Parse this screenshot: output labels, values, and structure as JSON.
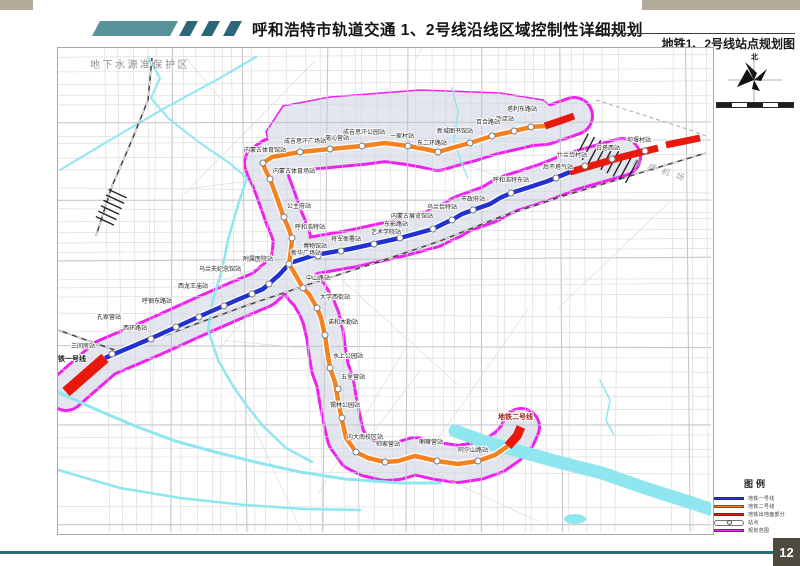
{
  "page": {
    "number": "12"
  },
  "header": {
    "title": "呼和浩特市轨道交通 1、2号线沿线区域控制性详细规划",
    "subtitle": "地铁1、2号线站点规划图"
  },
  "compass": {
    "north_label": "北"
  },
  "legend": {
    "title": "图例",
    "items": [
      {
        "type": "line",
        "color": "#2331d0",
        "label": "地铁一号线"
      },
      {
        "type": "line",
        "color": "#f5821f",
        "label": "地铁二号线"
      },
      {
        "type": "line",
        "color": "#e8180c",
        "label": "地铁出地面部分"
      },
      {
        "type": "station",
        "color": "#ffffff",
        "label": "站点"
      },
      {
        "type": "line",
        "color": "#ee22ee",
        "label": "规划范围"
      }
    ]
  },
  "map": {
    "labels": {
      "protection_zone": "地下水源准保护区",
      "airport": "白塔机场",
      "line1_terminal": "地铁一号线",
      "line2_terminal": "地铁二号线"
    },
    "colors": {
      "line1": "#2331d0",
      "line2": "#f5821f",
      "surface": "#e8180c",
      "boundary": "#ee22ee",
      "corridor": "#e3e6ee",
      "river": "#8fe6ef",
      "road": "#d7d7dd",
      "road_major": "#c6c6cf",
      "rail": "#4a4a4a",
      "label": "#1b1b1b"
    },
    "north_lobe": [
      [
        266,
        132
      ],
      [
        283,
        106
      ],
      [
        330,
        97
      ],
      [
        420,
        90
      ],
      [
        500,
        93
      ],
      [
        543,
        100
      ],
      [
        558,
        112
      ],
      [
        543,
        128
      ],
      [
        480,
        148
      ],
      [
        420,
        151
      ],
      [
        350,
        156
      ],
      [
        300,
        161
      ],
      [
        272,
        152
      ]
    ],
    "line1": {
      "name": "地铁一号线",
      "path": [
        [
          105,
          358
        ],
        [
          152,
          338
        ],
        [
          205,
          314
        ],
        [
          237,
          300
        ],
        [
          263,
          289
        ],
        [
          279,
          275
        ],
        [
          290,
          263
        ],
        [
          315,
          255
        ],
        [
          350,
          249
        ],
        [
          400,
          238
        ],
        [
          433,
          229
        ],
        [
          447,
          222
        ],
        [
          452,
          220
        ],
        [
          462,
          214
        ],
        [
          473,
          210
        ],
        [
          490,
          204
        ],
        [
          500,
          198
        ],
        [
          511,
          193
        ],
        [
          530,
          187
        ],
        [
          548,
          181
        ],
        [
          570,
          172
        ]
      ],
      "surface_segments": [
        {
          "w": 11,
          "pts": [
            [
              66,
              392
            ],
            [
              105,
              358
            ]
          ]
        },
        {
          "w": 7,
          "pts": [
            [
              570,
              172
            ],
            [
              622,
              157
            ],
            [
              658,
              148
            ]
          ]
        },
        {
          "w": 7,
          "pts": [
            [
              666,
              145
            ],
            [
              700,
              138
            ]
          ]
        }
      ],
      "terminal_label_pos": [
        51,
        361
      ],
      "stations": [
        {
          "name": "三间房站",
          "x": 112,
          "y": 354,
          "lx": 71,
          "ly": 348
        },
        {
          "name": "西环路站",
          "x": 151,
          "y": 339,
          "lx": 123,
          "ly": 330
        },
        {
          "name": "孔家营站",
          "x": 176,
          "y": 327,
          "lx": 97,
          "ly": 319
        },
        {
          "name": "呼钢东路站",
          "x": 199,
          "y": 317,
          "lx": 142,
          "ly": 303
        },
        {
          "name": "西龙王庙站",
          "x": 224,
          "y": 306,
          "lx": 178,
          "ly": 288
        },
        {
          "name": "乌兰夫纪念馆站",
          "x": 252,
          "y": 294,
          "lx": 199,
          "ly": 271
        },
        {
          "name": "附属医院站",
          "x": 269,
          "y": 284,
          "lx": 243,
          "ly": 261
        },
        {
          "name": "新华广场站",
          "x": 289,
          "y": 264,
          "lx": 291,
          "ly": 255
        },
        {
          "name": "博物馆站",
          "x": 318,
          "y": 256,
          "lx": 303,
          "ly": 248
        },
        {
          "name": "将军衙署站",
          "x": 341,
          "y": 251,
          "lx": 331,
          "ly": 241
        },
        {
          "name": "艺术学院站",
          "x": 374,
          "y": 244,
          "lx": 371,
          "ly": 234
        },
        {
          "name": "东影路站",
          "x": 400,
          "y": 238,
          "lx": 384,
          "ly": 226
        },
        {
          "name": "内蒙古展览馆站",
          "x": 433,
          "y": 229,
          "lx": 391,
          "ly": 218
        },
        {
          "name": "乌兰恰特站",
          "x": 452,
          "y": 220,
          "lx": 427,
          "ly": 209
        },
        {
          "name": "市政府站",
          "x": 473,
          "y": 210,
          "lx": 461,
          "ly": 201
        },
        {
          "name": "呼和浩特东站",
          "x": 511,
          "y": 193,
          "lx": 493,
          "ly": 182
        },
        {
          "name": "后不塔气站",
          "x": 556,
          "y": 178,
          "lx": 543,
          "ly": 169
        },
        {
          "name": "什兰岱村站",
          "x": 585,
          "y": 166,
          "lx": 557,
          "ly": 157
        },
        {
          "name": "白塔西站",
          "x": 612,
          "y": 159,
          "lx": 596,
          "ly": 150
        },
        {
          "name": "坝堰村站",
          "x": 645,
          "y": 151,
          "lx": 627,
          "ly": 142
        }
      ]
    },
    "line2": {
      "name": "地铁二号线",
      "path": [
        [
          508,
          446
        ],
        [
          495,
          455
        ],
        [
          478,
          461
        ],
        [
          458,
          464
        ],
        [
          437,
          461
        ],
        [
          415,
          456
        ],
        [
          398,
          461
        ],
        [
          385,
          462
        ],
        [
          368,
          458
        ],
        [
          356,
          452
        ],
        [
          346,
          438
        ],
        [
          342,
          420
        ],
        [
          338,
          400
        ],
        [
          335,
          382
        ],
        [
          330,
          368
        ],
        [
          327,
          350
        ],
        [
          325,
          335
        ],
        [
          321,
          318
        ],
        [
          317,
          308
        ],
        [
          309,
          294
        ],
        [
          303,
          288
        ],
        [
          295,
          274
        ],
        [
          289,
          264
        ],
        [
          291,
          250
        ],
        [
          292,
          238
        ],
        [
          288,
          227
        ],
        [
          284,
          218
        ],
        [
          277,
          198
        ],
        [
          270,
          179
        ],
        [
          265,
          169
        ],
        [
          263,
          163
        ],
        [
          272,
          157
        ],
        [
          300,
          152
        ],
        [
          330,
          149
        ],
        [
          362,
          146
        ],
        [
          385,
          143
        ],
        [
          408,
          146
        ],
        [
          425,
          149
        ],
        [
          438,
          152
        ],
        [
          455,
          147
        ],
        [
          470,
          143
        ],
        [
          492,
          136
        ],
        [
          514,
          131
        ],
        [
          531,
          127
        ],
        [
          545,
          126
        ]
      ],
      "surface_segments": [
        {
          "w": 7,
          "pts": [
            [
              545,
              126
            ],
            [
              560,
              121
            ],
            [
              574,
              116
            ]
          ]
        },
        {
          "w": 9,
          "pts": [
            [
              508,
              446
            ],
            [
              517,
              436
            ],
            [
              521,
              427
            ]
          ]
        }
      ],
      "terminal_label_pos": [
        498,
        419
      ],
      "stations": [
        {
          "name": "塔利东路站",
          "x": 531,
          "y": 127,
          "lx": 507,
          "ly": 111
        },
        {
          "name": "新店站",
          "x": 514,
          "y": 131,
          "lx": 496,
          "ly": 121
        },
        {
          "name": "百合路站",
          "x": 492,
          "y": 136,
          "lx": 476,
          "ly": 124
        },
        {
          "name": "新城图书馆站",
          "x": 470,
          "y": 143,
          "lx": 437,
          "ly": 133
        },
        {
          "name": "东二环路站",
          "x": 438,
          "y": 152,
          "lx": 417,
          "ly": 145
        },
        {
          "name": "一家村站",
          "x": 408,
          "y": 146,
          "lx": 390,
          "ly": 138
        },
        {
          "name": "成吉思汗公园站",
          "x": 362,
          "y": 146,
          "lx": 343,
          "ly": 134
        },
        {
          "name": "毫沁营站",
          "x": 330,
          "y": 149,
          "lx": 325,
          "ly": 140
        },
        {
          "name": "成吉思汗广场站",
          "x": 300,
          "y": 152,
          "lx": 284,
          "ly": 143
        },
        {
          "name": "内蒙古体育馆站",
          "x": 263,
          "y": 163,
          "lx": 244,
          "ly": 152
        },
        {
          "name": "内蒙古体育场站",
          "x": 270,
          "y": 179,
          "lx": 273,
          "ly": 173
        },
        {
          "name": "公主府站",
          "x": 284,
          "y": 217,
          "lx": 287,
          "ly": 208
        },
        {
          "name": "呼和浩特站",
          "x": 292,
          "y": 238,
          "lx": 295,
          "ly": 229
        },
        {
          "name": "中山路站",
          "x": 303,
          "y": 288,
          "lx": 306,
          "ly": 280
        },
        {
          "name": "大学西街站",
          "x": 317,
          "y": 308,
          "lx": 320,
          "ly": 299
        },
        {
          "name": "诺和木勒站",
          "x": 325,
          "y": 335,
          "lx": 328,
          "ly": 324
        },
        {
          "name": "水上公园站",
          "x": 330,
          "y": 368,
          "lx": 333,
          "ly": 358
        },
        {
          "name": "五里营站",
          "x": 338,
          "y": 389,
          "lx": 341,
          "ly": 379
        },
        {
          "name": "锡林公园站",
          "x": 342,
          "y": 418,
          "lx": 330,
          "ly": 407
        },
        {
          "name": "内大南校区站",
          "x": 356,
          "y": 452,
          "lx": 347,
          "ly": 439
        },
        {
          "name": "帅家营站",
          "x": 385,
          "y": 462,
          "lx": 376,
          "ly": 446
        },
        {
          "name": "喇嘛营站",
          "x": 437,
          "y": 461,
          "lx": 419,
          "ly": 444
        },
        {
          "name": "阿尔山路站",
          "x": 478,
          "y": 461,
          "lx": 458,
          "ly": 452
        }
      ]
    },
    "rivers": [
      {
        "w": 2,
        "pts": [
          [
            60,
            170
          ],
          [
            110,
            140
          ],
          [
            165,
            108
          ],
          [
            220,
            78
          ],
          [
            256,
            57
          ]
        ]
      },
      {
        "w": 2,
        "pts": [
          [
            148,
            57
          ],
          [
            160,
            78
          ],
          [
            151,
            98
          ],
          [
            168,
            118
          ],
          [
            200,
            143
          ],
          [
            228,
            162
          ],
          [
            247,
            178
          ]
        ]
      },
      {
        "w": 2.5,
        "pts": [
          [
            247,
            178
          ],
          [
            238,
            205
          ],
          [
            228,
            240
          ],
          [
            222,
            270
          ],
          [
            213,
            300
          ],
          [
            208,
            330
          ],
          [
            218,
            360
          ],
          [
            233,
            386
          ],
          [
            247,
            406
          ],
          [
            263,
            426
          ],
          [
            286,
            448
          ],
          [
            312,
            462
          ]
        ]
      },
      {
        "w": 3,
        "pts": [
          [
            58,
            392
          ],
          [
            95,
            409
          ],
          [
            135,
            426
          ],
          [
            175,
            441
          ],
          [
            215,
            452
          ],
          [
            255,
            462
          ],
          [
            300,
            472
          ],
          [
            345,
            479
          ],
          [
            400,
            483
          ],
          [
            440,
            483
          ]
        ]
      },
      {
        "w": 2.5,
        "pts": [
          [
            58,
            470
          ],
          [
            120,
            488
          ],
          [
            180,
            498
          ],
          [
            245,
            505
          ],
          [
            305,
            509
          ],
          [
            360,
            510
          ]
        ]
      },
      {
        "w": 1.5,
        "pts": [
          [
            452,
            88
          ],
          [
            458,
            112
          ],
          [
            454,
            140
          ],
          [
            461,
            162
          ],
          [
            468,
            178
          ]
        ]
      },
      {
        "w": 13,
        "pts": [
          [
            455,
            431
          ],
          [
            492,
            444
          ],
          [
            522,
            452
          ],
          [
            562,
            463
          ],
          [
            602,
            473
          ],
          [
            648,
            489
          ],
          [
            692,
            503
          ],
          [
            710,
            509
          ]
        ]
      },
      {
        "w": 1.5,
        "pts": [
          [
            600,
            380
          ],
          [
            610,
            400
          ],
          [
            606,
            420
          ],
          [
            614,
            435
          ]
        ]
      }
    ],
    "pond": {
      "cx": 575,
      "cy": 519,
      "rx": 11,
      "ry": 5
    },
    "railways": [
      [
        [
          58,
          330
        ],
        [
          120,
          352
        ],
        [
          185,
          328
        ],
        [
          245,
          306
        ],
        [
          310,
          284
        ],
        [
          375,
          263
        ],
        [
          440,
          241
        ],
        [
          500,
          217
        ],
        [
          560,
          197
        ],
        [
          620,
          179
        ],
        [
          706,
          153
        ]
      ],
      [
        [
          96,
          236
        ],
        [
          112,
          186
        ],
        [
          132,
          140
        ],
        [
          148,
          100
        ],
        [
          152,
          58
        ]
      ]
    ],
    "rail_yards": [
      {
        "cx": 610,
        "cy": 160,
        "n": 9,
        "len": 26,
        "gap": 7,
        "angle": -62
      },
      {
        "cx": 110,
        "cy": 210,
        "n": 6,
        "len": 20,
        "gap": 6,
        "angle": 25
      }
    ],
    "airport_dash": [
      [
        596,
        100
      ],
      [
        640,
        114
      ],
      [
        690,
        130
      ],
      [
        706,
        136
      ]
    ],
    "protection_zone_pos": [
      90,
      68
    ],
    "airport_label_pos": [
      632,
      164
    ]
  }
}
